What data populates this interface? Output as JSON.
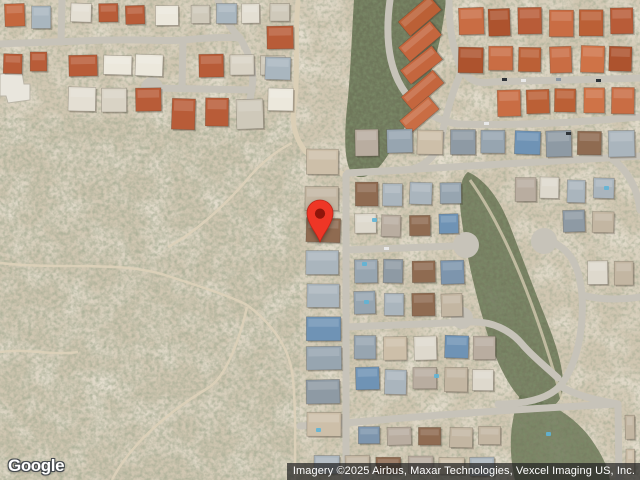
{
  "window": {
    "width": 640,
    "height": 480
  },
  "map": {
    "view_type": "satellite",
    "scene": "aerial imagery: desert scrubland on the left, residential streets with terracotta and gray rooftops on the right",
    "marker": {
      "label": "location-pin",
      "tip_x": 320,
      "tip_y": 243,
      "body_color": "#EE3626",
      "outline_color": "#BC271A",
      "dot_color": "#8F150B"
    }
  },
  "branding": {
    "logo_text": "Google"
  },
  "attribution": {
    "text": "Imagery ©2025 Airbus, Maxar Technologies, Vexcel Imaging US, Inc.",
    "background": "rgba(34,34,34,0.72)",
    "text_color": "#ffffff"
  },
  "palette": {
    "desert_base": "#d0c6b1",
    "desert_sand": "#ece5d5",
    "scrub_olive": "#6b7252",
    "wash_green": "#5f6a4c",
    "road_gray": "#c7c3b9",
    "dirt_track": "#dccfb4",
    "roof_terracotta": "#c2663e",
    "roof_gray_blue": "#7d95ad",
    "roof_white": "#e2ddd1",
    "pool_blue": "#5fb4d6"
  }
}
